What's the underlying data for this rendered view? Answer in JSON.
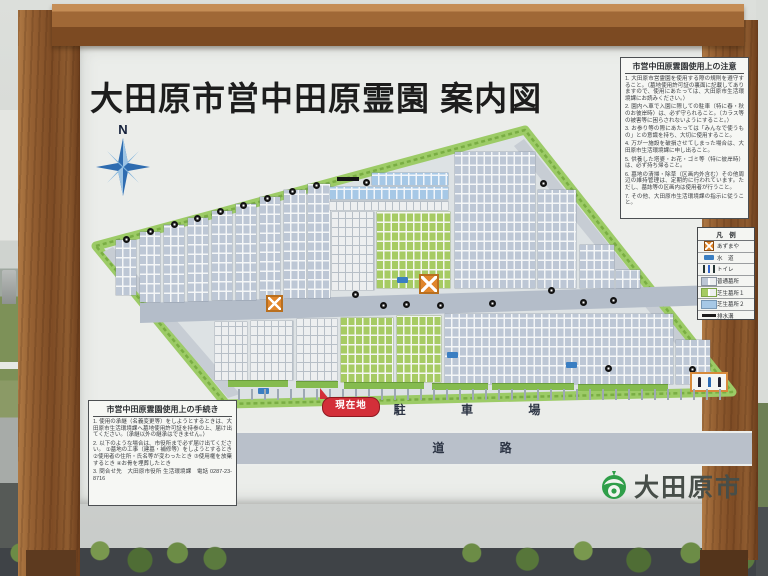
{
  "sign": {
    "title": "大田原市営中田原霊園 案内図",
    "notice_box": {
      "title": "市営中田原霊園使用上の注意",
      "items": [
        "1. 大田原市営霊園を使用する際の規則を遵守すること。（墓地使用許可証の裏面に記載してありますので、使用にあたっては、大田原市生活環境課にお読みください。）",
        "2. 園内へ車で入園に際しての駐車（特に春・秋のお彼岸時）は、必ず守られること。（カラス等の被害等に困らされないようにすること。）",
        "3. お参り等の際にあたっては「みんなで使うもの」との意識を持ち、大切に使用すること。",
        "4. 万が一施設を破損させてしまった場合は、大田原市生活環境課に申し出ること。",
        "5. 供養した塔婆・お花・ゴミ等（特に彼岸時）は、必ず持ち帰ること。",
        "6. 墓地の清掃・除草（区画内外含む）その他周辺の維持管理は、定期的に行われています。ただし、墓誌等の区画内は使用者が行うこと。",
        "7. その他、大田原市生活環境課の指示に従うこと。"
      ]
    },
    "procedure_box": {
      "title": "市営中田原霊園使用上の手続き",
      "items": [
        "1. 使用の承継（名義変更等）をしようとするときは、大田原市生活環境課へ墓地使用許可証を持参の上、届け出てください。（承継以外の継承はできません。）",
        "2. 以下のような場合は、市役所まで必ず届け出てください。 ①墓地の工事（建墓・補修等）をしようとするとき ②使用者の住所・氏名等が変わったとき ③使用権を放棄するとき ④お骨を埋葬したとき",
        "3. 問合せ先　大田原市役所 生活環境課　電話 0287-23-8716"
      ]
    },
    "legend": {
      "title": "凡　例",
      "rows": [
        {
          "swatch": "azumaya",
          "label": "あずまや"
        },
        {
          "swatch": "water",
          "label": "水　道"
        },
        {
          "swatch": "toilet",
          "label": "トイレ"
        },
        {
          "swatch": "gray",
          "label": "普通墓所"
        },
        {
          "swatch": "green",
          "label": "芝生墓所１"
        },
        {
          "swatch": "blue",
          "label": "芝生墓所２"
        },
        {
          "swatch": "drain",
          "label": "排水溝"
        }
      ]
    },
    "map_labels": {
      "current_location": "現在地",
      "parking": "駐 車 場",
      "road": "道 路",
      "compass_n": "N"
    },
    "logo": {
      "city": "大田原市"
    }
  },
  "colors": {
    "accent_red": "#d32f39",
    "hedge_green": "#9ccb66",
    "plot_gray": "#bdc7d5",
    "plot_green": "#a6cb63",
    "plot_blue": "#a6c8e6",
    "pavilion_orange": "#e0862c",
    "wood_brown": "#8f5c30",
    "logo_green": "#2f9e49"
  },
  "map": {
    "blocks": [
      {
        "x": 116,
        "y": 240,
        "w": 20,
        "h": 55,
        "c": "gray"
      },
      {
        "x": 140,
        "y": 232,
        "w": 20,
        "h": 70,
        "c": "gray"
      },
      {
        "x": 164,
        "y": 225,
        "w": 20,
        "h": 77,
        "c": "gray"
      },
      {
        "x": 188,
        "y": 218,
        "w": 20,
        "h": 83,
        "c": "gray"
      },
      {
        "x": 212,
        "y": 211,
        "w": 20,
        "h": 89,
        "c": "gray"
      },
      {
        "x": 236,
        "y": 204,
        "w": 20,
        "h": 96,
        "c": "gray"
      },
      {
        "x": 260,
        "y": 197,
        "w": 20,
        "h": 102,
        "c": "gray"
      },
      {
        "x": 284,
        "y": 190,
        "w": 22,
        "h": 108,
        "c": "gray"
      },
      {
        "x": 308,
        "y": 184,
        "w": 22,
        "h": 114,
        "c": "gray"
      },
      {
        "x": 372,
        "y": 173,
        "w": 76,
        "h": 12,
        "c": "blue"
      },
      {
        "x": 330,
        "y": 187,
        "w": 118,
        "h": 12,
        "c": "blue"
      },
      {
        "x": 330,
        "y": 201,
        "w": 118,
        "h": 9,
        "c": "white"
      },
      {
        "x": 332,
        "y": 212,
        "w": 42,
        "h": 78,
        "c": "white"
      },
      {
        "x": 377,
        "y": 212,
        "w": 73,
        "h": 76,
        "c": "green"
      },
      {
        "x": 455,
        "y": 152,
        "w": 80,
        "h": 136,
        "c": "gray"
      },
      {
        "x": 538,
        "y": 190,
        "w": 38,
        "h": 98,
        "c": "gray"
      },
      {
        "x": 580,
        "y": 245,
        "w": 34,
        "h": 43,
        "c": "gray"
      },
      {
        "x": 616,
        "y": 270,
        "w": 24,
        "h": 18,
        "c": "gray"
      },
      {
        "x": 215,
        "y": 322,
        "w": 32,
        "h": 58,
        "c": "white"
      },
      {
        "x": 251,
        "y": 321,
        "w": 42,
        "h": 59,
        "c": "white"
      },
      {
        "x": 297,
        "y": 319,
        "w": 40,
        "h": 61,
        "c": "white"
      },
      {
        "x": 341,
        "y": 318,
        "w": 52,
        "h": 64,
        "c": "green"
      },
      {
        "x": 397,
        "y": 316,
        "w": 44,
        "h": 66,
        "c": "green"
      },
      {
        "x": 445,
        "y": 314,
        "w": 228,
        "h": 70,
        "c": "gray"
      },
      {
        "x": 676,
        "y": 340,
        "w": 34,
        "h": 44,
        "c": "gray"
      }
    ],
    "hedge_strips": [
      [
        228,
        380,
        60
      ],
      [
        296,
        381,
        42
      ],
      [
        344,
        382,
        80
      ],
      [
        432,
        383,
        56
      ],
      [
        492,
        383,
        82
      ],
      [
        578,
        384,
        90
      ]
    ],
    "markers": [
      [
        123,
        236
      ],
      [
        147,
        228
      ],
      [
        171,
        221
      ],
      [
        194,
        215
      ],
      [
        217,
        208
      ],
      [
        240,
        202
      ],
      [
        264,
        195
      ],
      [
        289,
        188
      ],
      [
        313,
        182
      ],
      [
        363,
        179
      ],
      [
        540,
        180
      ],
      [
        352,
        291
      ],
      [
        380,
        302
      ],
      [
        403,
        301
      ],
      [
        437,
        302
      ],
      [
        489,
        300
      ],
      [
        548,
        287
      ],
      [
        580,
        299
      ],
      [
        610,
        297
      ],
      [
        605,
        365
      ],
      [
        689,
        366
      ]
    ],
    "water_points": [
      [
        397,
        277
      ],
      [
        447,
        352
      ],
      [
        566,
        362
      ],
      [
        258,
        388
      ]
    ],
    "pavilions": [
      [
        266,
        295,
        17
      ],
      [
        419,
        274,
        20
      ]
    ]
  }
}
